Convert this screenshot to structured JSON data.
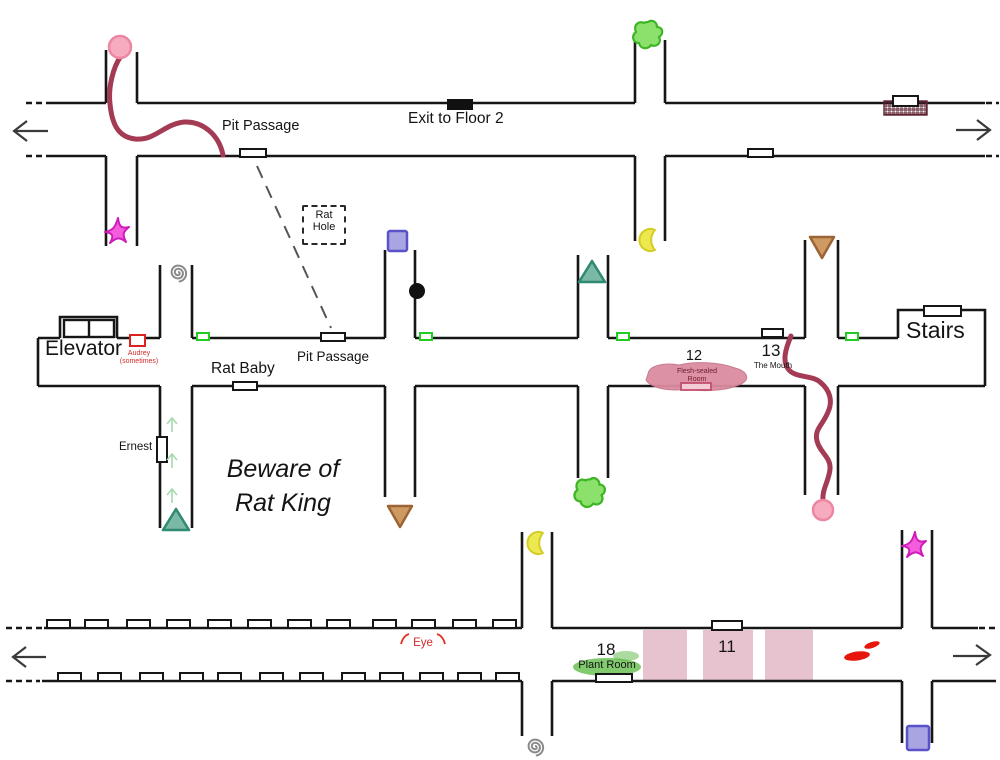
{
  "map": {
    "title": "hand-drawn floor corridor map",
    "labels": {
      "pit_passage_top": "Pit Passage",
      "exit_floor2": "Exit to Floor 2",
      "rat_hole_line1": "Rat",
      "rat_hole_line2": "Hole",
      "elevator": "Elevator",
      "audrey_line1": "Audrey",
      "audrey_line2": "(sometimes)",
      "rat_baby": "Rat Baby",
      "pit_passage_mid": "Pit Passage",
      "ernest": "Ernest",
      "beware_line1": "Beware of",
      "beware_line2": "Rat King",
      "room_12": "12",
      "flesh_room_line1": "Flesh-sealed",
      "flesh_room_line2": "Room",
      "room_13": "13",
      "the_mouth": "The Mouth",
      "stairs": "Stairs",
      "eye": "Eye",
      "room_18": "18",
      "plant_room": "Plant Room",
      "room_11": "11"
    },
    "colors": {
      "wall": "#161616",
      "route": "#a43b55",
      "pink_circle": "#f7abbe",
      "magenta_star": "#f45ede",
      "green_splat": "#8ce06c",
      "yellow_crescent": "#ece94f",
      "teal_triangle": "#7cb8a6",
      "brown_triangle": "#cf9a62",
      "purple_square": "#a9a5e2",
      "spiral_gray": "#8a8a8a",
      "green_door": "#22cc22",
      "red_door": "#dd2222",
      "pink_room_band": "#e7c3cf",
      "flesh_blob": "#db8ca0",
      "plant_green": "#57b83d",
      "red_scribble": "#e8150c",
      "red_text": "#d42a2a"
    },
    "icons": [
      {
        "name": "pink-circle-marker",
        "color": "#f7abbe"
      },
      {
        "name": "magenta-star-marker",
        "color": "#f45ede"
      },
      {
        "name": "green-splat-marker",
        "color": "#8ce06c"
      },
      {
        "name": "yellow-crescent-marker",
        "color": "#ece94f"
      },
      {
        "name": "teal-triangle-marker",
        "color": "#7cb8a6"
      },
      {
        "name": "brown-triangle-marker",
        "color": "#cf9a62"
      },
      {
        "name": "purple-square-marker",
        "color": "#a9a5e2"
      },
      {
        "name": "spiral-marker",
        "color": "#8a8a8a"
      },
      {
        "name": "black-dot-marker",
        "color": "#111111"
      },
      {
        "name": "vent-hatch-marker",
        "color": "#5e2130"
      },
      {
        "name": "door-marker",
        "color": "#161616"
      },
      {
        "name": "green-door-marker",
        "color": "#22cc22"
      },
      {
        "name": "red-door-marker",
        "color": "#dd2222"
      },
      {
        "name": "red-scribble-marker",
        "color": "#e8150c"
      },
      {
        "name": "route-line",
        "color": "#a43b55"
      },
      {
        "name": "arrow-left-icon",
        "color": "#3a3a3a"
      },
      {
        "name": "arrow-right-icon",
        "color": "#3a3a3a"
      }
    ]
  }
}
